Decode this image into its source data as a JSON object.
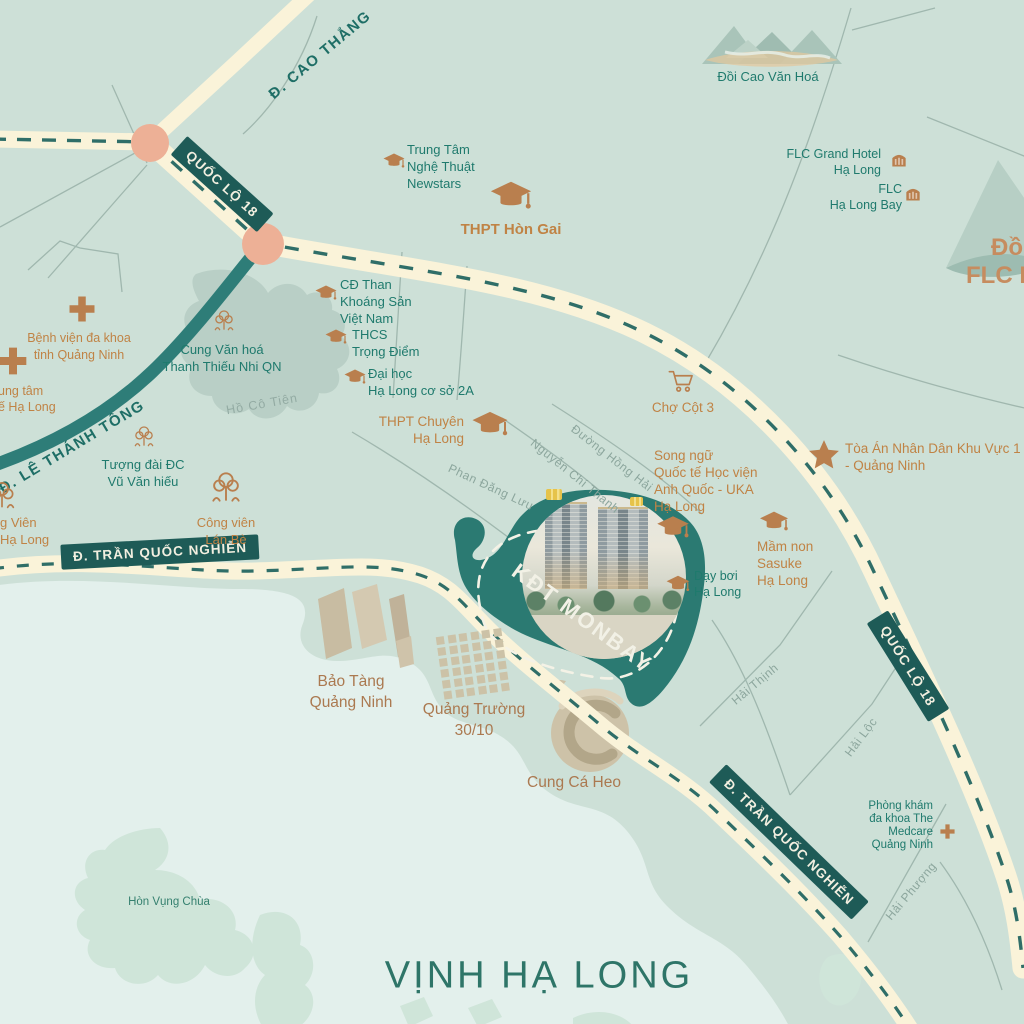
{
  "palette": {
    "land": "#cde0d7",
    "sea": "#e3f0ec",
    "road": "#faf3d9",
    "road_dash": "#2f6e68",
    "teal_road": "#2e7d78",
    "badge_bg": "#1e5b57",
    "badge_text": "#f2efe0",
    "teal_text": "#1f7a6d",
    "orange_text": "#c08345",
    "brown_text": "#ab7950",
    "grey_street": "#8ca69d",
    "icon_orange": "#b97f4e",
    "monbay_area": "#2b7a72",
    "island": "#cfe5d9",
    "lake": "#b9cfc6",
    "junction": "#edb096",
    "gold": "#e6c34a"
  },
  "monbay": {
    "label": "KĐT MONBAY"
  },
  "badges": [
    {
      "id": "quoc-lo-18-nw",
      "text": "QUỐC LỘ 18",
      "x": 222,
      "y": 184,
      "rotate": 42
    },
    {
      "id": "quoc-lo-18-se",
      "text": "QUỐC LỘ 18",
      "x": 908,
      "y": 666,
      "rotate": 58
    },
    {
      "id": "tran-quoc-nghien-w",
      "text": "Đ. TRẦN QUỐC NGHIỄN",
      "x": 160,
      "y": 552,
      "rotate": -3
    },
    {
      "id": "tran-quoc-nghien-se",
      "text": "Đ. TRẦN QUỐC NGHIỄN",
      "x": 789,
      "y": 842,
      "rotate": 44
    }
  ],
  "road_labels": [
    {
      "id": "le-thanh-tong",
      "text": "Đ. LÊ THÁNH TÔNG",
      "x": 72,
      "y": 447,
      "rotate": -31
    },
    {
      "id": "cao-thang",
      "text": "Đ. CAO THẮNG",
      "x": 320,
      "y": 55,
      "rotate": -40
    }
  ],
  "street_labels": [
    {
      "text": "Phan Đăng Lưu",
      "x": 491,
      "y": 487,
      "rotate": 25
    },
    {
      "text": "Nguyễn Chí Thanh",
      "x": 575,
      "y": 476,
      "rotate": 39
    },
    {
      "text": "Đường Hồng Hải",
      "x": 612,
      "y": 458,
      "rotate": 38
    },
    {
      "text": "Hải Thịnh",
      "x": 755,
      "y": 684,
      "rotate": -40
    },
    {
      "text": "Hải Lộc",
      "x": 861,
      "y": 737,
      "rotate": -53
    },
    {
      "text": "Hải Phượng",
      "x": 911,
      "y": 891,
      "rotate": -50
    }
  ],
  "water_labels": [
    {
      "id": "ho-co-tien",
      "kind": "lake",
      "text": "Hồ Cô Tiên",
      "x": 262,
      "y": 404,
      "rotate": -10,
      "size": 12.5
    },
    {
      "id": "hon-vung-chua",
      "kind": "island",
      "text": "Hòn Vụng Chùa",
      "x": 169,
      "y": 902,
      "rotate": 0,
      "size": 11.5
    },
    {
      "id": "vinh-ha-long",
      "kind": "sea",
      "text": "VỊNH HẠ LONG",
      "x": 539,
      "y": 976,
      "rotate": 0,
      "size": 38
    }
  ],
  "edge_labels": [
    {
      "id": "doi-flc-line1",
      "text": "Đồi",
      "left": 991,
      "top": 234
    },
    {
      "id": "doi-flc-line2",
      "text": "FLC Hạ Long",
      "left": 966,
      "top": 262
    }
  ],
  "poi": [
    {
      "id": "benh-vien-da-khoa",
      "lines": [
        "Bệnh viện đa khoa",
        "tỉnh Quảng Ninh"
      ],
      "anchor": "c",
      "x": 79,
      "top": 330,
      "color": "orange",
      "size": 12.5,
      "lh": 17
    },
    {
      "id": "trung-tam-y-te",
      "lines": [
        "ung tâm",
        "ế Hạ Long"
      ],
      "anchor": "l",
      "x": -2,
      "top": 383,
      "color": "orange",
      "size": 12.5,
      "lh": 16
    },
    {
      "id": "cung-van-hoa-thieu-nhi",
      "lines": [
        "Cung Văn hoá",
        "Thanh Thiếu Nhi QN"
      ],
      "anchor": "c",
      "x": 222,
      "top": 341,
      "color": "teal",
      "size": 13,
      "lh": 17
    },
    {
      "id": "trung-tam-nghe-thuat-newstars",
      "lines": [
        "Trung Tâm",
        "Nghệ Thuật",
        "Newstars"
      ],
      "anchor": "l",
      "x": 407,
      "top": 141,
      "color": "teal",
      "size": 13,
      "lh": 17
    },
    {
      "id": "thpt-hon-gai",
      "lines": [
        "THPT Hòn Gai"
      ],
      "anchor": "c",
      "x": 511,
      "top": 220,
      "color": "orange",
      "size": 15,
      "lh": 20,
      "bold": true
    },
    {
      "id": "cd-than-khoang-san",
      "lines": [
        "CĐ Than",
        "Khoáng Sản",
        "Việt Nam"
      ],
      "anchor": "l",
      "x": 340,
      "top": 276,
      "color": "teal",
      "size": 13,
      "lh": 17
    },
    {
      "id": "thcs-trong-diem",
      "lines": [
        "THCS",
        "Trọng Điểm"
      ],
      "anchor": "l",
      "x": 352,
      "top": 326,
      "color": "teal",
      "size": 13,
      "lh": 17
    },
    {
      "id": "dai-hoc-ha-long",
      "lines": [
        "Đại học",
        "Hạ Long cơ sở 2A"
      ],
      "anchor": "l",
      "x": 368,
      "top": 365,
      "color": "teal",
      "size": 13,
      "lh": 17
    },
    {
      "id": "thpt-chuyen-ha-long",
      "lines": [
        "THPT Chuyên",
        "Hạ Long"
      ],
      "anchor": "r",
      "x": 560,
      "top": 413,
      "color": "orange",
      "size": 13.5,
      "lh": 17
    },
    {
      "id": "cho-cot-3",
      "lines": [
        "Chợ Cột 3"
      ],
      "anchor": "c",
      "x": 683,
      "top": 399,
      "color": "orange",
      "size": 13.5,
      "lh": 17
    },
    {
      "id": "toa-an-nhan-dan",
      "lines": [
        "Tòa Án Nhân Dân Khu Vực 1",
        "- Quảng Ninh"
      ],
      "anchor": "l",
      "x": 845,
      "top": 440,
      "color": "orange",
      "size": 13.5,
      "lh": 17
    },
    {
      "id": "song-ngu-uka",
      "lines": [
        "Song ngữ",
        "Quốc tế Học viện",
        "Anh Quốc - UKA",
        "Hạ Long"
      ],
      "anchor": "l",
      "x": 654,
      "top": 447,
      "color": "orange",
      "size": 13.5,
      "lh": 17
    },
    {
      "id": "mam-non-sasuke",
      "lines": [
        "Mầm non",
        "Sasuke",
        "Hạ Long"
      ],
      "anchor": "l",
      "x": 757,
      "top": 538,
      "color": "orange",
      "size": 13.5,
      "lh": 17
    },
    {
      "id": "day-boi-ha-long",
      "lines": [
        "Dạy bơi",
        "Hạ Long"
      ],
      "anchor": "l",
      "x": 694,
      "top": 568,
      "color": "teal",
      "size": 12.5,
      "lh": 16
    },
    {
      "id": "tuong-dai-vu-van-hieu",
      "lines": [
        "Tượng đài ĐC",
        "Vũ Văn hiếu"
      ],
      "anchor": "c",
      "x": 143,
      "top": 456,
      "color": "teal",
      "size": 13,
      "lh": 17
    },
    {
      "id": "cong-vien-lan-be",
      "lines": [
        "Công viên",
        "Lán Bè"
      ],
      "anchor": "c",
      "x": 226,
      "top": 514,
      "color": "orange",
      "size": 13,
      "lh": 17
    },
    {
      "id": "cong-vien-ha-long",
      "lines": [
        "g Viên",
        "Hạ Long"
      ],
      "anchor": "l",
      "x": 0,
      "top": 514,
      "color": "orange",
      "size": 13,
      "lh": 17
    },
    {
      "id": "bao-tang-quang-ninh",
      "lines": [
        "Bảo Tàng",
        "Quảng Ninh"
      ],
      "anchor": "c",
      "x": 351,
      "top": 671,
      "color": "brown",
      "size": 15.5,
      "lh": 21
    },
    {
      "id": "quang-truong-30-10",
      "lines": [
        "Quảng Trường",
        "30/10"
      ],
      "anchor": "c",
      "x": 474,
      "top": 699,
      "color": "brown",
      "size": 15.5,
      "lh": 21
    },
    {
      "id": "cung-ca-heo",
      "lines": [
        "Cung Cá Heo"
      ],
      "anchor": "c",
      "x": 574,
      "top": 772,
      "color": "brown",
      "size": 15.5,
      "lh": 21
    },
    {
      "id": "phong-kham-medcare",
      "lines": [
        "Phòng khám",
        "đa khoa The",
        "Medcare",
        "Quảng Ninh"
      ],
      "anchor": "r",
      "x": 91,
      "top": 800,
      "color": "teal",
      "size": 11.5,
      "lh": 13
    },
    {
      "id": "flc-grand-hotel",
      "lines": [
        "FLC Grand Hotel",
        "Hạ Long"
      ],
      "anchor": "r",
      "x": 143,
      "top": 146,
      "color": "teal",
      "size": 12.5,
      "lh": 16
    },
    {
      "id": "flc-ha-long-bay",
      "lines": [
        "FLC",
        "Hạ Long Bay"
      ],
      "anchor": "r",
      "x": 122,
      "top": 181,
      "color": "teal",
      "size": 12.5,
      "lh": 16
    },
    {
      "id": "doi-cao-van-hoa",
      "lines": [
        "Đồi Cao Văn Hoá"
      ],
      "anchor": "c",
      "x": 768,
      "top": 68,
      "color": "teal",
      "size": 13,
      "lh": 17
    }
  ],
  "icons": [
    {
      "type": "cross",
      "x": 82,
      "y": 309,
      "size": 30
    },
    {
      "type": "cross",
      "x": 13,
      "y": 361,
      "size": 32
    },
    {
      "type": "cross",
      "x": 947,
      "y": 831,
      "size": 17
    },
    {
      "type": "cap",
      "x": 394,
      "y": 162,
      "size": 24
    },
    {
      "type": "cap",
      "x": 511,
      "y": 198,
      "size": 46
    },
    {
      "type": "cap",
      "x": 326,
      "y": 294,
      "size": 24
    },
    {
      "type": "cap",
      "x": 336,
      "y": 338,
      "size": 24
    },
    {
      "type": "cap",
      "x": 355,
      "y": 378,
      "size": 24
    },
    {
      "type": "cap",
      "x": 490,
      "y": 426,
      "size": 40
    },
    {
      "type": "cap",
      "x": 673,
      "y": 529,
      "size": 36
    },
    {
      "type": "cap",
      "x": 774,
      "y": 523,
      "size": 32
    },
    {
      "type": "cap",
      "x": 678,
      "y": 585,
      "size": 26
    },
    {
      "type": "tree",
      "x": 224,
      "y": 321,
      "size": 26
    },
    {
      "type": "tree",
      "x": 144,
      "y": 437,
      "size": 26
    },
    {
      "type": "tree-park",
      "x": 226,
      "y": 488,
      "size": 38
    },
    {
      "type": "tree-park",
      "x": 2,
      "y": 496,
      "size": 34
    },
    {
      "type": "cart",
      "x": 681,
      "y": 381,
      "size": 28
    },
    {
      "type": "star",
      "x": 824,
      "y": 455,
      "size": 34
    },
    {
      "type": "hotel",
      "x": 899,
      "y": 159,
      "size": 20
    },
    {
      "type": "hotel",
      "x": 913,
      "y": 193,
      "size": 20
    }
  ]
}
